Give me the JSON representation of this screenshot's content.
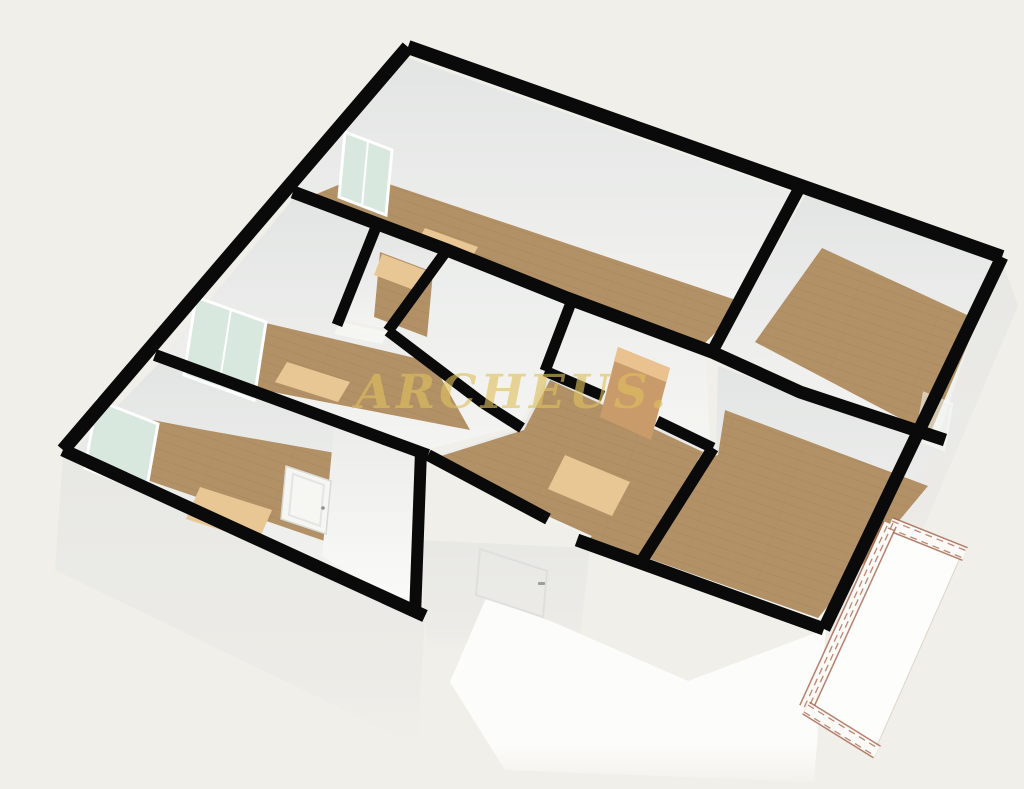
{
  "watermark": {
    "text": "ARCHEUS."
  },
  "scene": {
    "description": "3D isometric rendering of an apartment floor plan with black wall tops, wooden floors, light rugs, windows and a brick-edged balcony",
    "rooms": [
      {
        "name": "top-bedroom",
        "floor": "wood",
        "rug": true,
        "window": true
      },
      {
        "name": "top-right-room",
        "floor": "wood",
        "window": true
      },
      {
        "name": "middle-left-bedroom",
        "floor": "wood",
        "rug": true,
        "window": true
      },
      {
        "name": "closet",
        "floor": "wood",
        "rug": true
      },
      {
        "name": "hallway",
        "floor": "white"
      },
      {
        "name": "center-room",
        "floor": "wood",
        "rug": true
      },
      {
        "name": "bottom-left-bedroom",
        "floor": "wood",
        "rug": true,
        "window": true,
        "door": "white-closed"
      },
      {
        "name": "bottom-right-room",
        "floor": "wood"
      },
      {
        "name": "balcony",
        "floor": "white",
        "parapet": "brick"
      }
    ],
    "doors": [
      "open-wood-door-center-hall",
      "white-door-bottom-left-room",
      "entrance-door-front-wall"
    ]
  },
  "colors": {
    "bg": "#f1efe9",
    "wall": "#0a0a0a",
    "wood": "#b39166",
    "woodLine": "#8a6a45",
    "rug": "#e9c795",
    "glass": "#d9e8df",
    "frame": "#ffffff",
    "faceTop": "#e3e5e4",
    "faceBottom": "#f4f4f2",
    "extFace": "#e8e8e5",
    "brightFace": "#fcfcfa",
    "parapet": "#fbfaf7",
    "brick": "#a5604a",
    "doorTan": "#c99a6a",
    "doorTanTop": "#eac28f",
    "gold": "#dfc05e",
    "handle": "#8f8f8b"
  }
}
